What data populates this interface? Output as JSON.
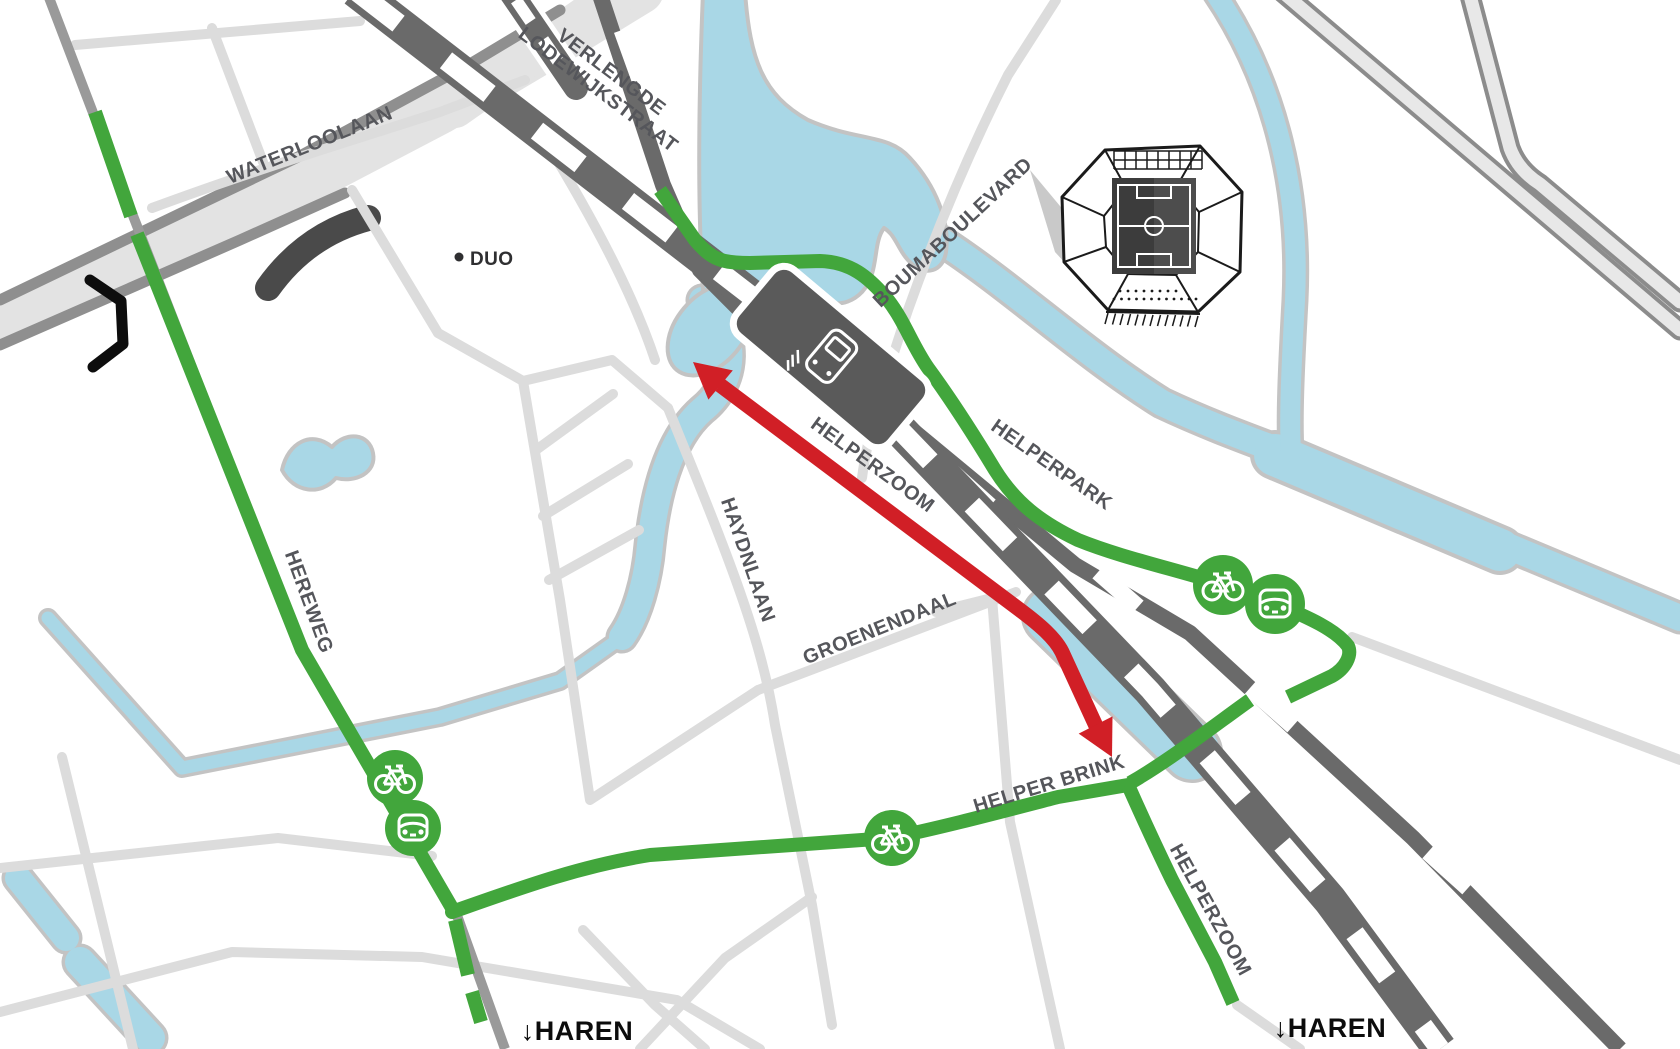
{
  "map": {
    "street_labels": {
      "waterloolaan": "WATERLOOLAAN",
      "verlengde_line1": "VERLENGDE",
      "verlengde_line2": "LODEWIJKSTRAAT",
      "duo": "DUO",
      "boumaboulevard": "BOUMABOULEVARD",
      "helperzoom_closed": "HELPERZOOM",
      "helperpark": "HELPERPARK",
      "haydnlaan": "HAYDNLAAN",
      "groenendaal": "GROENENDAAL",
      "hereweg": "HEREWEG",
      "helper_brink": "HELPER BRINK",
      "helperzoom_south": "HELPERZOOM",
      "haren_southwest": "↓HAREN",
      "haren_southeast": "↓HAREN"
    },
    "colors": {
      "route_green": "#42a63c",
      "closed_red": "#d11f26",
      "water": "#a9d7e6",
      "rail_dark": "#6a6a6a",
      "street_light": "#dcdcdc",
      "label_gray": "#55565b"
    },
    "icons": {
      "bicycle": "bicycle-route-marker",
      "car": "car-route-marker",
      "train": "train-station-marker",
      "stadium": "stadium-euroborg"
    }
  }
}
